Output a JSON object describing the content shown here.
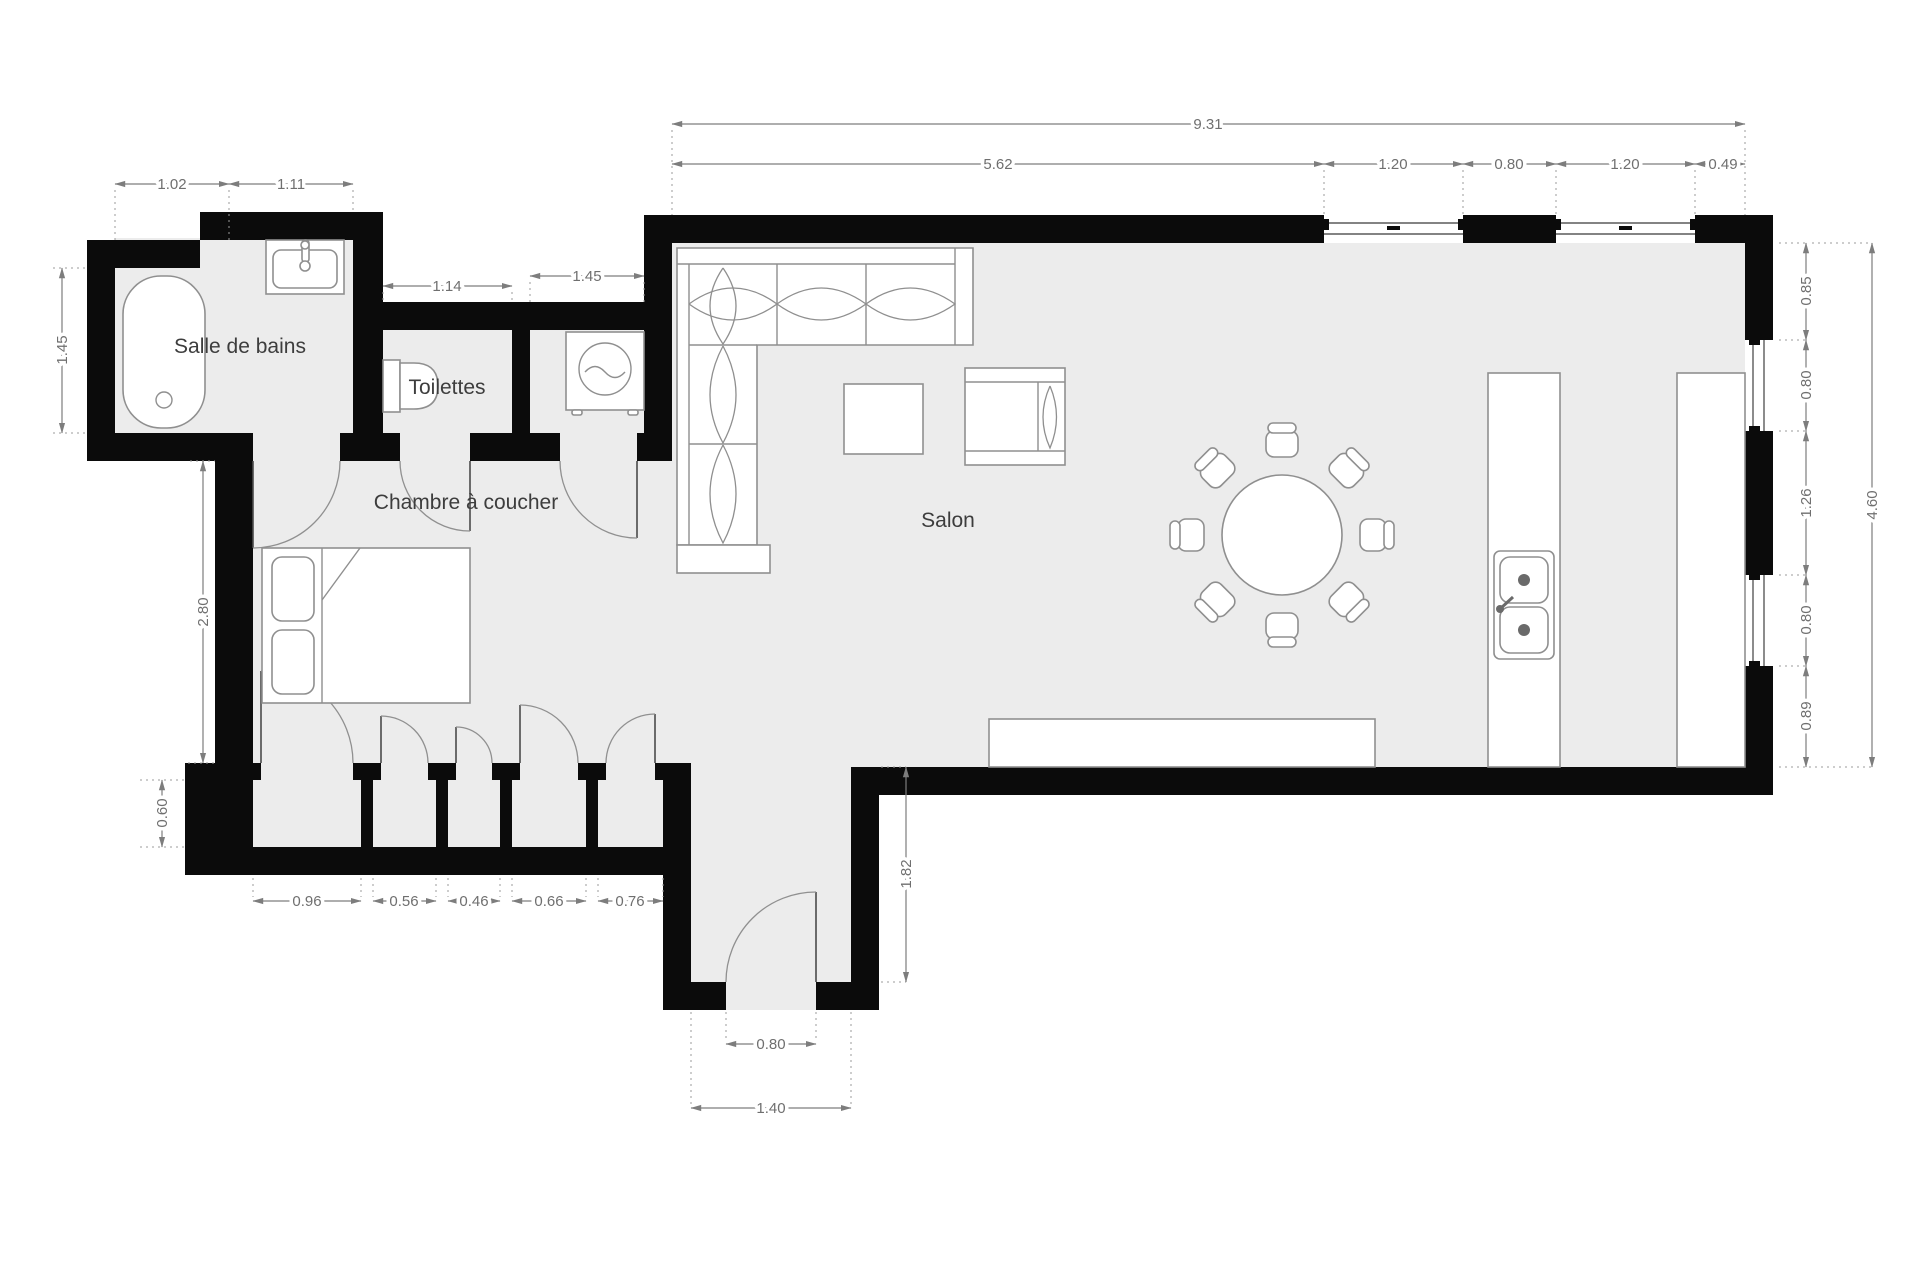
{
  "rooms": {
    "bathroom": "Salle de bains",
    "toilets": "Toilettes",
    "bedroom": "Chambre à coucher",
    "living_room": "Salon"
  },
  "dims": {
    "overall_width": "9.31",
    "top_segments": [
      "5.62",
      "1.20",
      "0.80",
      "1.20",
      "0.49"
    ],
    "bathroom_top": [
      "1.02",
      "1.11"
    ],
    "toilets_width": "1.14",
    "utility_width": "1.45",
    "bathroom_height": "1.45",
    "bedroom_height": "2.80",
    "closet_depth": "0.60",
    "closet_widths": [
      "0.96",
      "0.56",
      "0.46",
      "0.66",
      "0.76"
    ],
    "entry_hall_depth": "1.82",
    "entry_door_width": "0.80",
    "entry_width": "1.40",
    "right_segments": [
      "0.85",
      "0.80",
      "1.26",
      "0.80",
      "0.89"
    ],
    "overall_height": "4.60"
  },
  "colors": {
    "wall": "#0b0b0b",
    "floor": "#ececec",
    "dimension": "#7d7d7d",
    "label": "#3d3d3d",
    "furniture_stroke": "#8f8f8f"
  }
}
